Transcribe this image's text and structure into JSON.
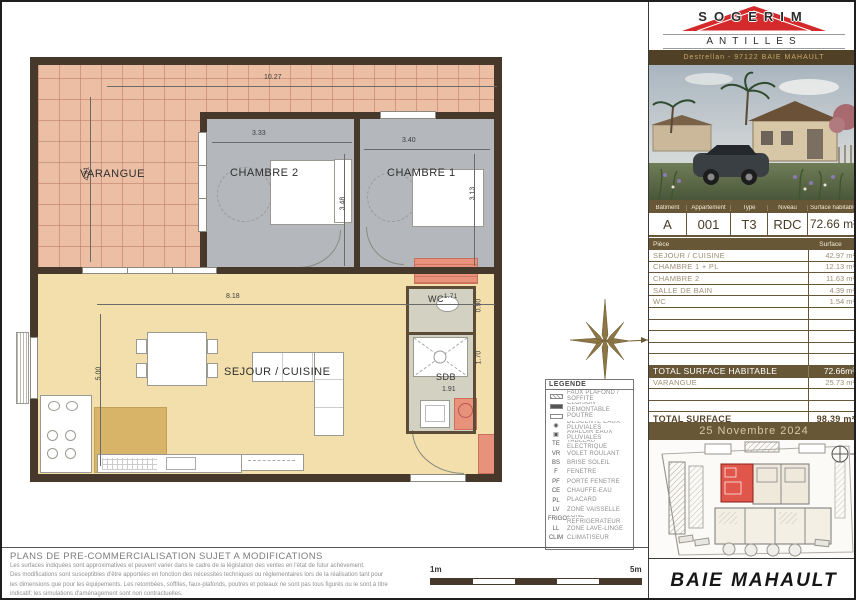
{
  "plan": {
    "rooms": {
      "varangue": "VARANGUE",
      "chambre2": "CHAMBRE 2",
      "chambre1": "CHAMBRE 1",
      "sejour": "SEJOUR / CUISINE",
      "wc": "WC",
      "sdb": "SDB"
    },
    "dims": {
      "top_width": "10.27",
      "varangue_h": "4.91",
      "chambre2_w": "3.33",
      "chambre1_w": "3.40",
      "chambre2_h": "3.48",
      "chambre1_h": "3.13",
      "sejour_w": "8.18",
      "sejour_h": "5.00",
      "wc_w": "1.71",
      "wc_h": "0.90",
      "sdb_h": "1.70",
      "sdb_w": "1.91"
    },
    "legend": {
      "title": "LEGENDE",
      "items": [
        {
          "sym": "hatch",
          "label": "FAUX PLAFOND / SOFFITE"
        },
        {
          "sym": "solid",
          "label": "CLOISON DEMONTABLE"
        },
        {
          "sym": "beam",
          "label": "POUTRE"
        },
        {
          "sym": "glyph-ep",
          "abbr": "◉",
          "label": "DESCENTE EAUX PLUVIALES"
        },
        {
          "sym": "glyph-av",
          "abbr": "▣",
          "label": "AVALOIR EAUX PLUVIALES"
        },
        {
          "abbr": "TE",
          "label": "TABLEAU ELECTRIQUE"
        },
        {
          "abbr": "VR",
          "label": "VOLET ROULANT"
        },
        {
          "abbr": "BS",
          "label": "BRISE SOLEIL"
        },
        {
          "abbr": "F",
          "label": "FENETRE"
        },
        {
          "abbr": "PF",
          "label": "PORTE FENETRE"
        },
        {
          "abbr": "CE",
          "label": "CHAUFFE-EAU"
        },
        {
          "abbr": "PL",
          "label": "PLACARD"
        },
        {
          "abbr": "LV",
          "label": "ZONE VAISSELLE"
        },
        {
          "abbr": "FRIGO",
          "label": "ZONE REFRIGERATEUR"
        },
        {
          "abbr": "LL",
          "label": "ZONE LAVE-LINGE"
        },
        {
          "abbr": "CLIM",
          "label": "CLIMATISEUR"
        }
      ]
    },
    "scale": {
      "min": "1m",
      "max": "5m"
    },
    "disclaimer": {
      "title": "PLANS DE PRE-COMMERCIALISATION SUJET A MODIFICATIONS",
      "lines": [
        "Les surfaces indiquées sont approximatives et peuvent varier dans le cadre de la législation des ventes en l'état de futur achèvement.",
        "Des modifications sont susceptibles d'être apportées en fonction des nécessités techniques ou réglementaires lors de la réalisation tant pour",
        "les dimensions que pour les équipements. Les retombées, soffites, faux-plafonds, poutres et poteaux ne sont pas tous figurés ou le sont à titre",
        "indicatif; les simulations d'aménagement sont non contractuelles."
      ]
    }
  },
  "panel": {
    "brand": {
      "name": "SOGERIM",
      "tagline": "L'IMMOBILIER CONTEMPORAIN",
      "region": "ANTILLES",
      "address": "Destrellan - 97122 BAIE MAHAULT",
      "red": "#d42a2c"
    },
    "unit": {
      "headers": [
        "Bâtiment",
        "Appartement",
        "Type",
        "Niveau",
        "Surface habitable"
      ],
      "values": [
        "A",
        "001",
        "T3",
        "RDC",
        "72.66 m²"
      ]
    },
    "surfaces": {
      "col_piece": "Pièce",
      "col_surface": "Surface",
      "rows": [
        {
          "name": "SEJOUR / CUISINE",
          "value": "42.97 m²"
        },
        {
          "name": "CHAMBRE 1 + PL",
          "value": "12.13 m²"
        },
        {
          "name": "CHAMBRE 2",
          "value": "11.63 m²"
        },
        {
          "name": "SALLE DE BAIN",
          "value": "4.39 m²"
        },
        {
          "name": "WC",
          "value": "1.54 m²"
        },
        {
          "name": "",
          "value": ""
        },
        {
          "name": "",
          "value": ""
        },
        {
          "name": "",
          "value": ""
        },
        {
          "name": "",
          "value": ""
        },
        {
          "name": "",
          "value": ""
        },
        {
          "name": "TOTAL SURFACE HABITABLE",
          "value": "72.66m²",
          "style": "total"
        },
        {
          "name": "VARANGUE",
          "value": "25.73 m²"
        },
        {
          "name": "",
          "value": ""
        },
        {
          "name": "",
          "value": ""
        },
        {
          "name": "TOTAL SURFACE",
          "value": "98.39 m²",
          "style": "grand"
        }
      ]
    },
    "date": "25 Novembre 2024",
    "city": "BAIE MAHAULT"
  }
}
